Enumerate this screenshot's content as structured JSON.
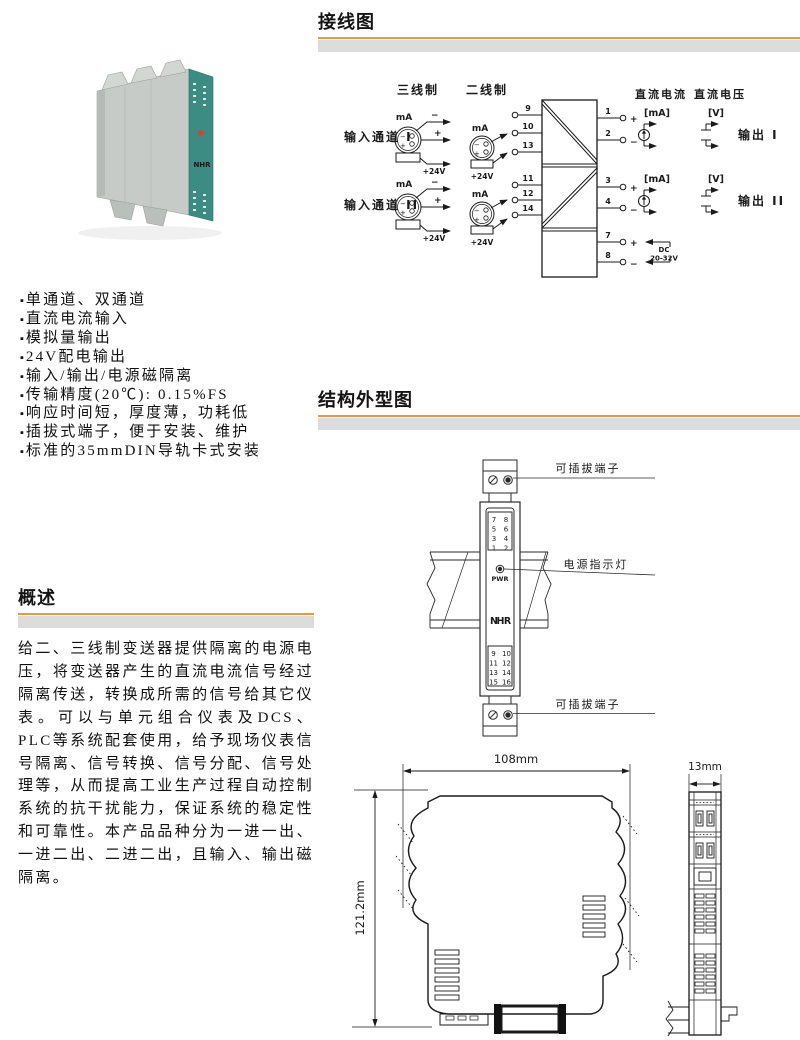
{
  "page": {
    "accent_color": "#F0953F",
    "bar_color": "#DCDCDC"
  },
  "headers": {
    "wiring": "接线图",
    "structure": "结构外型图",
    "overview": "概述"
  },
  "features": {
    "items": [
      "单通道、双通道",
      "直流电流输入",
      "模拟量输出",
      "24V配电输出",
      "输入/输出/电源磁隔离",
      "传输精度(20℃): 0.15%FS",
      "响应时间短，厚度薄，功耗低",
      "插拔式端子，便于安装、维护",
      "标准的35mmDIN导轨卡式安装"
    ]
  },
  "overview": {
    "text": "给二、三线制变送器提供隔离的电源电压，将变送器产生的直流电流信号经过隔离传送，转换成所需的信号给其它仪表。可以与单元组合仪表及DCS、PLC等系统配套使用，给予现场仪表信号隔离、信号转换、信号分配、信号处理等，从而提高工业生产过程自动控制系统的抗干扰能力，保证系统的稳定性和可靠性。本产品品种分为一进一出、一进二出、二进二出，且输入、输出磁隔离。"
  },
  "photo": {
    "logo": "NHR"
  },
  "wiring": {
    "three_wire": "三线制",
    "two_wire": "二线制",
    "input_ch1": "输入通道 I",
    "input_ch2": "输入通道 II",
    "ma": "mA",
    "v24": "+24V",
    "plus": "+",
    "minus": "−",
    "dc_current": "直流电流",
    "dc_voltage": "直流电压",
    "ma_unit": "[mA]",
    "v_unit": "[V]",
    "output1": "输出 I",
    "output2": "输出 II",
    "dc": "DC",
    "dc_range": "20-32V",
    "t": {
      "1": "1",
      "2": "2",
      "3": "3",
      "4": "4",
      "7": "7",
      "8": "8",
      "9": "9",
      "10": "10",
      "11": "11",
      "12": "12",
      "13": "13",
      "14": "14"
    }
  },
  "structure": {
    "callout_top": "可插拔端子",
    "callout_mid": "电源指示灯",
    "callout_bottom": "可插拔端子",
    "pwr": "PWR",
    "logo_n": "N",
    "logo_h": "H",
    "logo_r": "R",
    "top_left": [
      "7",
      "5",
      "3",
      "1"
    ],
    "top_right": [
      "8",
      "6",
      "4",
      "2"
    ],
    "bottom_left": [
      "9",
      "11",
      "13",
      "15"
    ],
    "bottom_right": [
      "10",
      "12",
      "14",
      "16"
    ]
  },
  "dims": {
    "width": "108mm",
    "height": "121.2mm",
    "thickness": "13mm"
  }
}
